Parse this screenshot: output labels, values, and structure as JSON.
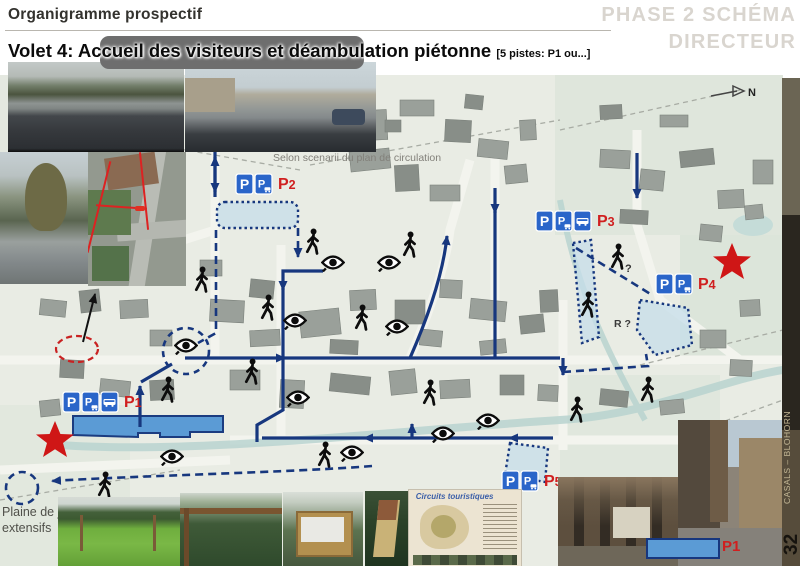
{
  "header": {
    "title": "Organigramme prospectif",
    "phase_line1": "PHASE 2 SCHÉMA",
    "phase_line2": "DIRECTEUR",
    "subtitle": "Volet 4: Accueil des visiteurs et déambulation piétonne",
    "subtitle_note": "[5 pistes: P1 ou...]"
  },
  "sidebar": {
    "credit": "CASALS – BLOHORN",
    "page_number": "32"
  },
  "map": {
    "scenario_note": "Selon scenarii du plan de circulation",
    "playground_label_line1": "Plaine de jeux",
    "playground_label_line2": "extensifs",
    "r_label": "R ?",
    "question_label": "?",
    "north_label": "N",
    "legend": {
      "label": "P1"
    },
    "parkings": [
      {
        "label": "P1",
        "x": 63,
        "y": 317,
        "signs": [
          "p",
          "p-caravan",
          "bus"
        ]
      },
      {
        "label": "P2",
        "x": 236,
        "y": 99,
        "signs": [
          "p",
          "p-caravan"
        ]
      },
      {
        "label": "P3",
        "x": 536,
        "y": 136,
        "signs": [
          "p",
          "p-caravan",
          "bus"
        ]
      },
      {
        "label": "P4",
        "x": 656,
        "y": 199,
        "signs": [
          "p",
          "p-caravan"
        ]
      },
      {
        "label": "P5",
        "x": 502,
        "y": 396,
        "signs": [
          "p",
          "p-caravan"
        ]
      }
    ],
    "eyes": [
      [
        333,
        187
      ],
      [
        389,
        187
      ],
      [
        295,
        245
      ],
      [
        397,
        251
      ],
      [
        186,
        270
      ],
      [
        298,
        322
      ],
      [
        352,
        377
      ],
      [
        443,
        358
      ],
      [
        488,
        345
      ],
      [
        172,
        381
      ]
    ],
    "pedestrians": [
      [
        313,
        167
      ],
      [
        410,
        170
      ],
      [
        618,
        182
      ],
      [
        202,
        205
      ],
      [
        268,
        233
      ],
      [
        362,
        243
      ],
      [
        588,
        230
      ],
      [
        252,
        297
      ],
      [
        430,
        318
      ],
      [
        168,
        315
      ],
      [
        105,
        410
      ],
      [
        325,
        380
      ],
      [
        577,
        335
      ],
      [
        648,
        315
      ]
    ],
    "stars": [
      [
        55,
        365
      ],
      [
        732,
        187
      ]
    ]
  },
  "poster": {
    "title": "Circuits touristiques"
  },
  "colors": {
    "route": "#17377e",
    "parking_blue": "#2a65c9",
    "label_red": "#d01f1f",
    "area_blue": "#5b9bd5"
  }
}
